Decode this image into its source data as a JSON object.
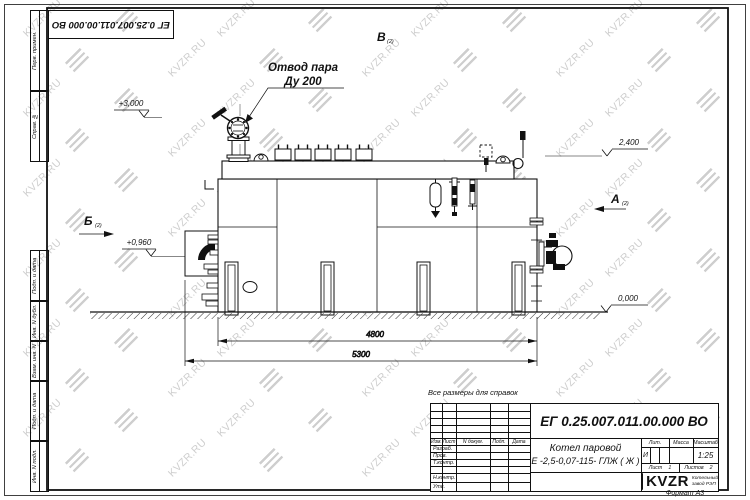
{
  "watermark": {
    "text": "KVZR.RU"
  },
  "top_stamp": "ЕГ 0.25.007.011.00.000  ВО",
  "frame": {
    "left_labels": [
      "Перв. примен.",
      "Справ. №",
      "Подп. и дата",
      "Инв. N дубл.",
      "Взам. инв. N",
      "Подп. и дата",
      "Инв. N подл."
    ],
    "format_label": "Формат А3"
  },
  "drawing": {
    "note": "Все размеры для справок",
    "callout_line1": "Отвод пара",
    "callout_line2": "Ду 200",
    "elevation_top": "+3,000",
    "elevation_burner": "+0,960",
    "elevation_right": "2,400",
    "elevation_ground": "0,000",
    "dim_inner": "4800",
    "dim_overall": "5300",
    "view_a": "А",
    "view_b": "Б",
    "view_v": "В",
    "view_sheet_ref": "(2)"
  },
  "title_block": {
    "doc_number": "ЕГ 0.25.007.011.00.000  ВО",
    "product_line1": "Котел паровой",
    "product_line2": "Е -2,5-0,07-115- ГЛЖ ( Ж )",
    "header_cols": [
      "Изм.",
      "Лист",
      "N докум.",
      "Подп.",
      "Дата"
    ],
    "row_labels": [
      "Разраб.",
      "Пров.",
      "Т.контр.",
      "Н.контр.",
      "Утв."
    ],
    "lit_label": "Лит.",
    "lit_value": "И",
    "mass_label": "Масса",
    "scale_label": "Масштаб",
    "scale_value": "1:25",
    "sheet_label": "Лист",
    "sheet_value": "1",
    "sheets_label": "Листов",
    "sheets_value": "2",
    "company": "KVZR",
    "company_sub1": "Котельный",
    "company_sub2": "завод РЭП"
  }
}
